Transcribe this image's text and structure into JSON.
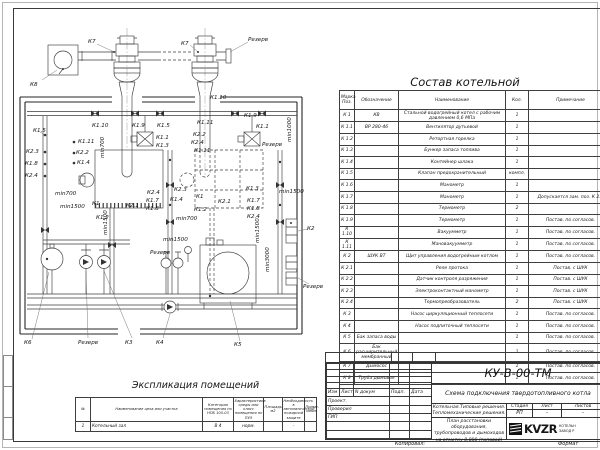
{
  "sheet": {
    "copied_label": "Копировал:",
    "format_label": "Формат"
  },
  "parts_table": {
    "title": "Состав котельной",
    "headers": {
      "mark": "Марка Поз.",
      "designation": "Обозначение",
      "name": "Наименование",
      "qty": "Кол.",
      "note": "Примечание"
    },
    "rows": [
      [
        "К 1",
        "КВ",
        "Стальной водогрейный котел с рабочим давлением 0,6 МПа",
        "1",
        ""
      ],
      [
        "К 1.1",
        "ВР 280-46",
        "Вентилятор дутьевой",
        "1",
        ""
      ],
      [
        "К 1.2",
        "",
        "Ретортная горелка",
        "1",
        ""
      ],
      [
        "К 1.3",
        "",
        "Бункер запаса топлива",
        "1",
        ""
      ],
      [
        "К 1.4",
        "",
        "Контейнер шлака",
        "1",
        ""
      ],
      [
        "К 1.5",
        "",
        "Клапан предохранительный",
        "компл.",
        ""
      ],
      [
        "К 1.6",
        "",
        "Манометр",
        "1",
        ""
      ],
      [
        "К 1.7",
        "",
        "Манометр",
        "1",
        "Допускается зам. поз. К 2.3"
      ],
      [
        "К 1.8",
        "",
        "Термометр",
        "2",
        ""
      ],
      [
        "К 1.9",
        "",
        "Термометр",
        "1",
        "Постав. по согласов."
      ],
      [
        "К 1.10",
        "",
        "Вакуумметр",
        "1",
        "Постав. по согласов."
      ],
      [
        "К 1.11",
        "",
        "Мановакуумметр",
        "1",
        "Постав. по согласов."
      ],
      [
        "К 2",
        "ШУК ВТ",
        "Щит управления водогрейным котлом",
        "1",
        "Постав. по согласов."
      ],
      [
        "К 2.1",
        "",
        "Реле протока",
        "1",
        "Постав. с ШУК"
      ],
      [
        "К 2.2",
        "",
        "Датчик контроля разряжения",
        "1",
        "Постав. с ШУК"
      ],
      [
        "К 2.3",
        "",
        "Электроконтактный манометр",
        "1",
        "Постав. с ШУК"
      ],
      [
        "К 2.4",
        "",
        "Термопреобразователь",
        "2",
        "Постав. с ШУК"
      ],
      [
        "К 3",
        "",
        "Насос циркуляционный теплосети",
        "1",
        "Постав. по согласов."
      ],
      [
        "К 4",
        "",
        "Насос подпиточный теплосети",
        "1",
        "Постав. по согласов."
      ],
      [
        "К 5",
        "Бак запаса воды",
        "",
        "1",
        "Постав. по согласов."
      ],
      [
        "К 6",
        "Бак расширительный мембранный",
        "",
        "1",
        "Постав. по согласов."
      ],
      [
        "К 7",
        "Дымосос",
        "",
        "1",
        "Постав. по согласов."
      ],
      [
        "К 8",
        "Труба дымовая",
        "",
        "1",
        "Постав. по согласов."
      ]
    ]
  },
  "explication": {
    "title": "Экспликация помещений",
    "headers": [
      "№",
      "Наименование цеха или участка",
      "Категория помещения по НПБ 105-03",
      "Характеристика среды или класс помещения по ПУЭ",
      "Площадь, м2",
      "Необходимость в автоматической пожарной защите",
      "Приме- чание"
    ],
    "rows": [
      [
        "1",
        "Котельный зал",
        "В 4",
        "норм.",
        "",
        "-",
        ""
      ]
    ]
  },
  "title_block": {
    "doc_number": "КУ-В-00-ТМ",
    "scheme_name": "Схема подключения твердотопливного котла",
    "object_line1": "Котельная.Типовые решения.",
    "object_line2": "Тепломеханические решения.",
    "sheet_title": "План расстановки оборудования, трубопроводов и дымоходов на отметку 0,000 (типовой)",
    "stage_label": "Стадия",
    "sheet_label": "Лист",
    "sheets_label": "Листов",
    "stage": "РП",
    "sheet_num": "-",
    "sheets_num": "-",
    "columns": [
      "Изм",
      "Лист",
      "N докум",
      "Подп.",
      "Дата"
    ],
    "roles": [
      "Проект.",
      "Проверил",
      "ГИП"
    ],
    "logo_text": "KVZR",
    "company_line1": "КОТЕЛЬН",
    "company_line2": "ЗАВОД Р"
  },
  "schematic": {
    "labels": [
      {
        "t": "К8",
        "x": 30,
        "y": 86
      },
      {
        "t": "К7",
        "x": 88,
        "y": 43
      },
      {
        "t": "К7",
        "x": 181,
        "y": 45
      },
      {
        "t": "Резерв",
        "x": 248,
        "y": 41
      },
      {
        "t": "К1.10",
        "x": 92,
        "y": 127
      },
      {
        "t": "К1.9",
        "x": 132,
        "y": 127
      },
      {
        "t": "К1.5",
        "x": 157,
        "y": 127
      },
      {
        "t": "К1.11",
        "x": 197,
        "y": 124
      },
      {
        "t": "К1.10",
        "x": 210,
        "y": 99
      },
      {
        "t": "К1.9",
        "x": 244,
        "y": 117
      },
      {
        "t": "К1.1",
        "x": 256,
        "y": 128
      },
      {
        "t": "Резерв",
        "x": 262,
        "y": 146
      },
      {
        "t": "К1.5",
        "x": 33,
        "y": 132
      },
      {
        "t": "К2.3",
        "x": 26,
        "y": 153
      },
      {
        "t": "К1.8",
        "x": 25,
        "y": 165
      },
      {
        "t": "К2.4",
        "x": 25,
        "y": 177
      },
      {
        "t": "К1.11",
        "x": 78,
        "y": 143
      },
      {
        "t": "К2.2",
        "x": 76,
        "y": 154
      },
      {
        "t": "К1.4",
        "x": 77,
        "y": 164
      },
      {
        "t": "К1.1",
        "x": 156,
        "y": 139
      },
      {
        "t": "К1.3",
        "x": 156,
        "y": 147
      },
      {
        "t": "К2.2",
        "x": 193,
        "y": 136
      },
      {
        "t": "К2.4",
        "x": 191,
        "y": 144
      },
      {
        "t": "К1.11",
        "x": 194,
        "y": 152
      },
      {
        "t": "К1",
        "x": 92,
        "y": 205
      },
      {
        "t": "К2.1",
        "x": 126,
        "y": 207
      },
      {
        "t": "К1.2",
        "x": 96,
        "y": 219
      },
      {
        "t": "К2.4",
        "x": 147,
        "y": 194
      },
      {
        "t": "К1.7",
        "x": 146,
        "y": 202
      },
      {
        "t": "К1.8",
        "x": 146,
        "y": 210
      },
      {
        "t": "К2.3",
        "x": 174,
        "y": 191
      },
      {
        "t": "К1.4",
        "x": 170,
        "y": 201
      },
      {
        "t": "К1",
        "x": 196,
        "y": 198
      },
      {
        "t": "К2.1",
        "x": 218,
        "y": 203
      },
      {
        "t": "К1.2",
        "x": 194,
        "y": 211
      },
      {
        "t": "К1.3",
        "x": 246,
        "y": 190
      },
      {
        "t": "К1.7",
        "x": 247,
        "y": 202
      },
      {
        "t": "К1.8",
        "x": 247,
        "y": 210
      },
      {
        "t": "К2.4",
        "x": 247,
        "y": 218
      },
      {
        "t": "min700",
        "x": 55,
        "y": 195
      },
      {
        "t": "min1500",
        "x": 60,
        "y": 208
      },
      {
        "t": "min700",
        "x": 176,
        "y": 220
      },
      {
        "t": "min1500",
        "x": 279,
        "y": 193
      },
      {
        "t": "min1500",
        "x": 163,
        "y": 241
      },
      {
        "t": "min700",
        "x": 104,
        "y": 158,
        "r": -90
      },
      {
        "t": "min1500",
        "x": 107,
        "y": 235,
        "r": -90
      },
      {
        "t": "min1500",
        "x": 259,
        "y": 243,
        "r": -90
      },
      {
        "t": "min1000",
        "x": 291,
        "y": 142,
        "r": -90
      },
      {
        "t": "min3000",
        "x": 269,
        "y": 272,
        "r": -90
      },
      {
        "t": "К2",
        "x": 307,
        "y": 230
      },
      {
        "t": "Резерв",
        "x": 303,
        "y": 288
      },
      {
        "t": "К6",
        "x": 24,
        "y": 344
      },
      {
        "t": "Резерв",
        "x": 78,
        "y": 344
      },
      {
        "t": "К3",
        "x": 125,
        "y": 344
      },
      {
        "t": "К4",
        "x": 156,
        "y": 344
      },
      {
        "t": "К5",
        "x": 234,
        "y": 346
      },
      {
        "t": "Резерв",
        "x": 150,
        "y": 254
      }
    ]
  }
}
